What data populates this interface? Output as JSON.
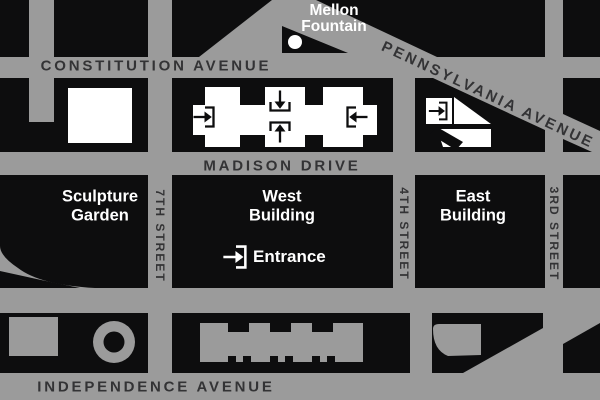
{
  "colors": {
    "road_gray": "#9b9b9b",
    "block_black": "#0d0d0e",
    "street_label": "#333335",
    "place_label": "#ffffff"
  },
  "streets": {
    "constitution": "CONSTITUTION AVENUE",
    "pennsylvania": "PENNSYLVANIA AVENUE",
    "madison": "MADISON DRIVE",
    "independence": "INDEPENDENCE AVENUE",
    "seventh": "7TH STREET",
    "fourth": "4TH STREET",
    "third": "3RD STREET"
  },
  "places": {
    "mellon_fountain": "Mellon\nFountain",
    "sculpture_garden": "Sculpture\nGarden",
    "west_building": "West\nBuilding",
    "east_building": "East\nBuilding"
  },
  "legend": {
    "entrance": "Entrance",
    "entrance_icon": "arrow-into-doorway"
  }
}
